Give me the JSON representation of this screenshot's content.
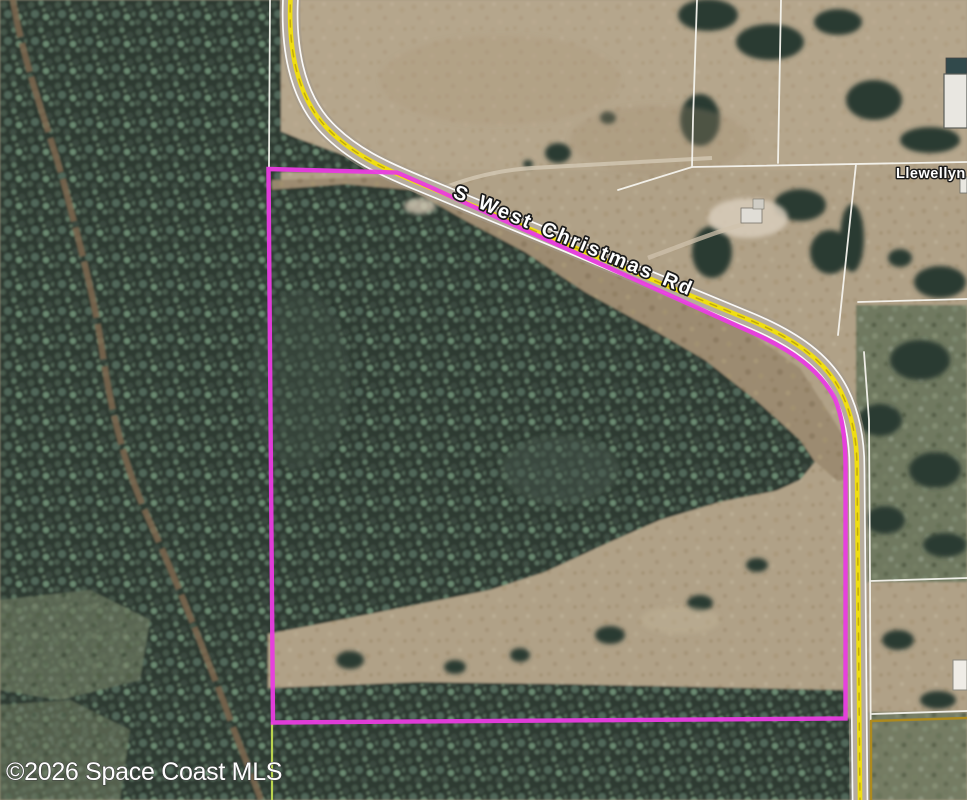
{
  "map": {
    "type": "aerial-parcel-view",
    "labels": {
      "road": "S West Christmas Rd",
      "side_road": "Llewellyn"
    },
    "watermark": "©2026 Space Coast MLS",
    "colors": {
      "property_boundary": "#e93ce0",
      "road_centerline": "#f0de12",
      "road_edge_line": "#ffffff",
      "parcel_line_white": "#f6f4ee",
      "parcel_line_gold": "#ad8a1e",
      "parcel_line_green": "#b9d44f",
      "road_label_text": "#ffffff",
      "side_road_label_text": "#ffffff",
      "watermark_text": "#ffffff"
    }
  }
}
